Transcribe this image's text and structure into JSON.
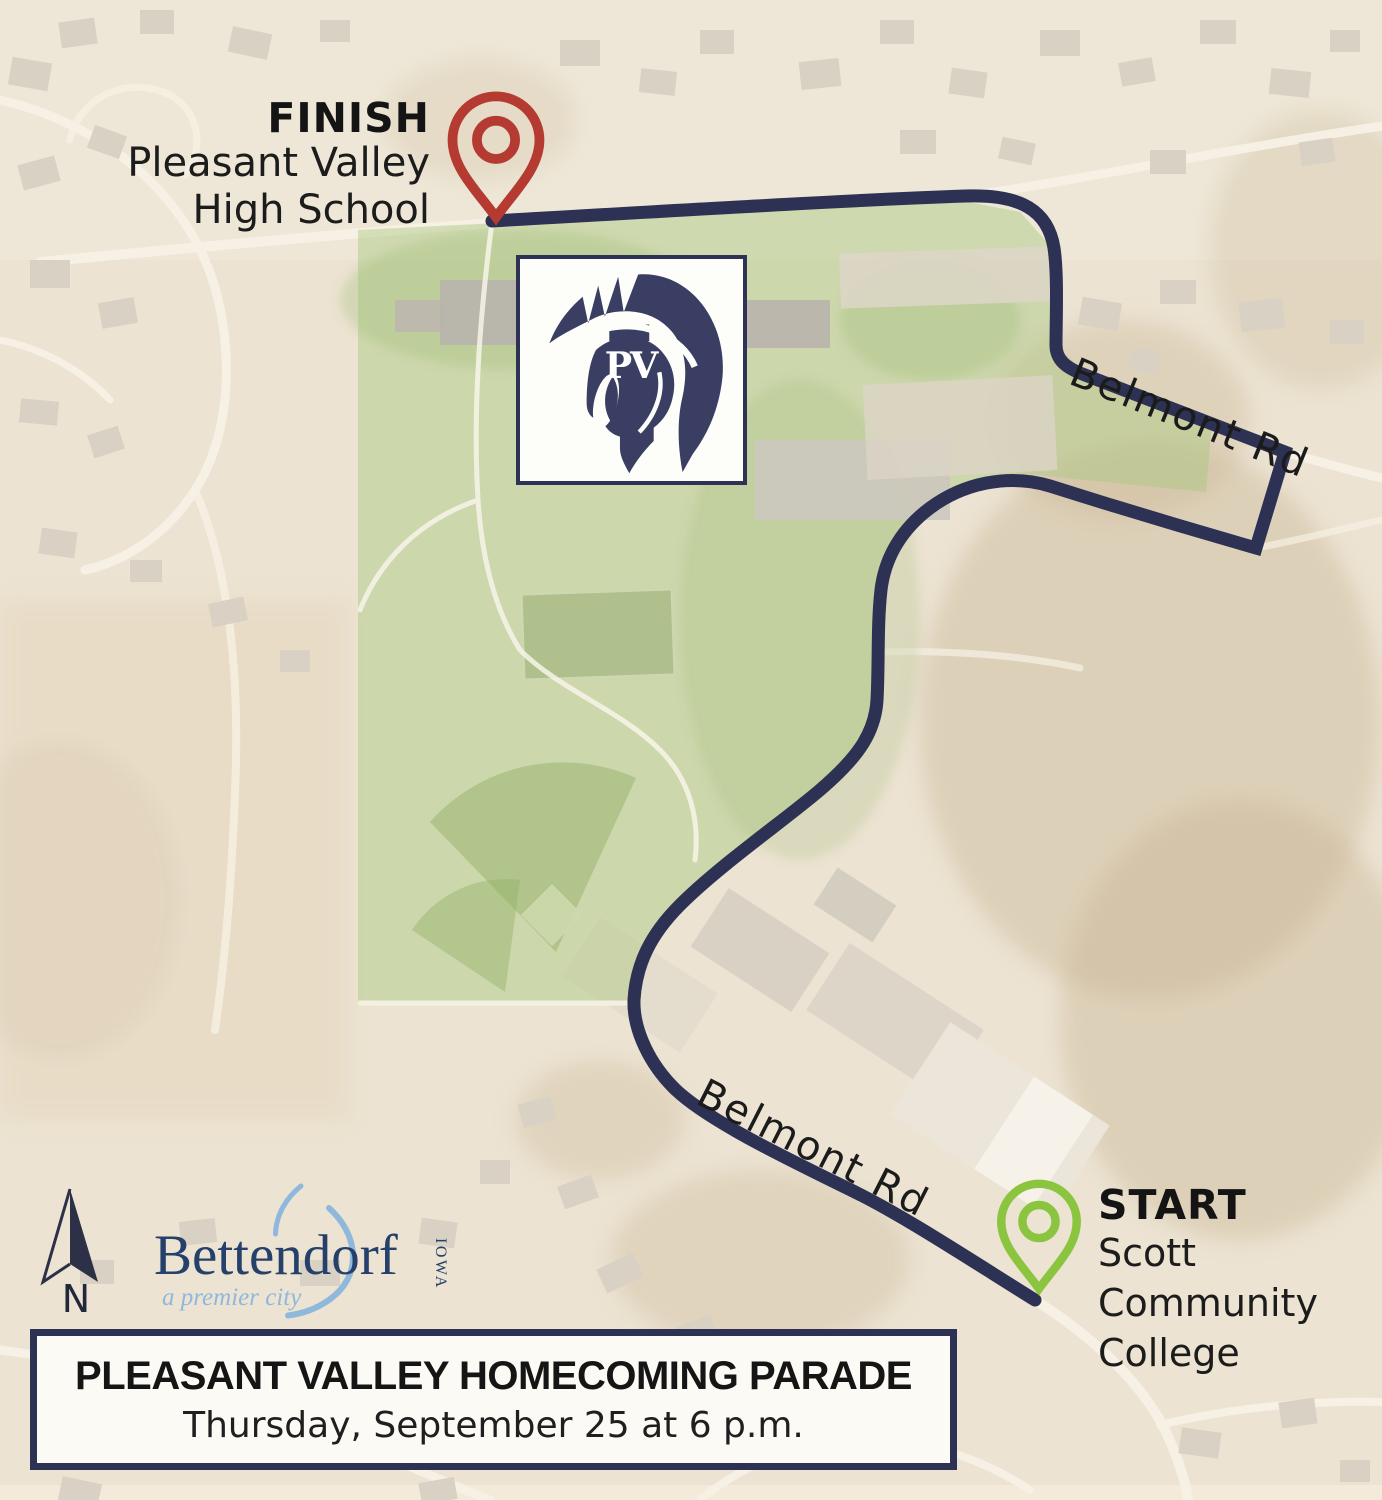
{
  "map": {
    "finish": {
      "label": "FINISH",
      "lines": [
        "Pleasant Valley",
        "High School"
      ]
    },
    "start": {
      "label": "START",
      "lines": [
        "Scott",
        "Community",
        "College"
      ]
    },
    "road_labels": [
      {
        "text": "Belmont Rd"
      },
      {
        "text": "Belmont Rd"
      }
    ],
    "school_logo": {
      "monogram": "PV"
    },
    "compass": {
      "label": "N"
    },
    "city_logo": {
      "city": "Bettendorf",
      "state": "IOWA",
      "tagline": "a premier city"
    },
    "colors": {
      "route": "#2d3153",
      "finish_pin": "#b53a31",
      "start_pin": "#8bc53f",
      "campus_overlay": "#a9c77e",
      "logo_navy": "#3a3e62",
      "city_navy": "#24406b",
      "city_blue": "#8fb8dc"
    }
  },
  "banner": {
    "title": "PLEASANT VALLEY HOMECOMING PARADE",
    "subtitle": "Thursday, September 25 at 6 p.m."
  }
}
